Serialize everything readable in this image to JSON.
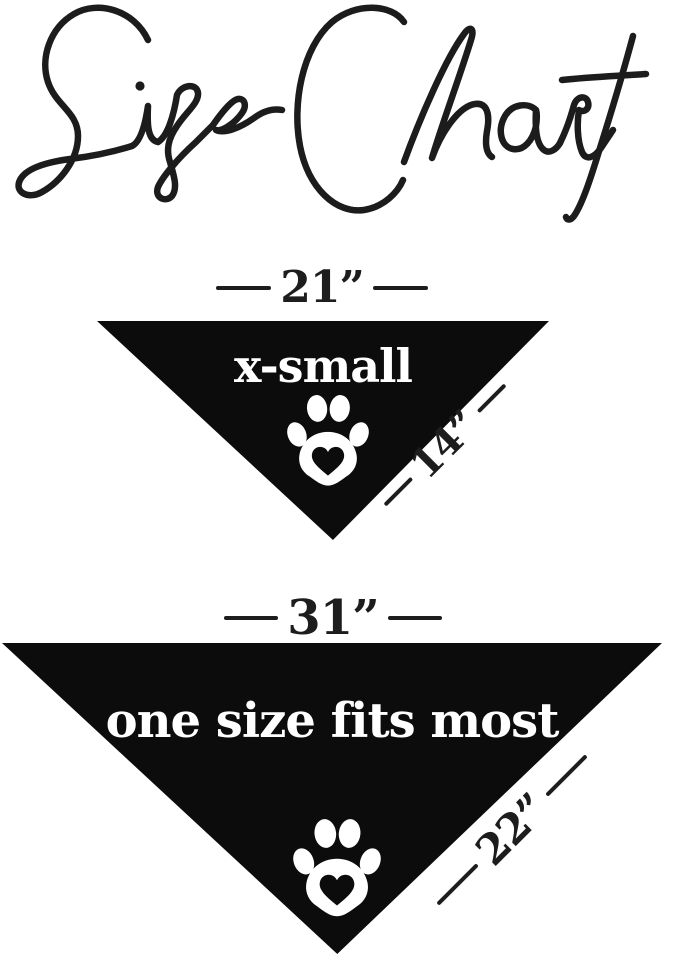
{
  "title": {
    "text": "Size Chart"
  },
  "colors": {
    "background": "#ffffff",
    "ink": "#1d1d1d",
    "bandana": "#0c0c0c",
    "bandana_text": "#ffffff"
  },
  "sizes": [
    {
      "name": "x-small",
      "top_width": "21”",
      "side_length": "14”",
      "icon": "paw-heart-icon"
    },
    {
      "name": "one size fits most",
      "top_width": "31”",
      "side_length": "22”",
      "icon": "paw-heart-icon"
    }
  ]
}
